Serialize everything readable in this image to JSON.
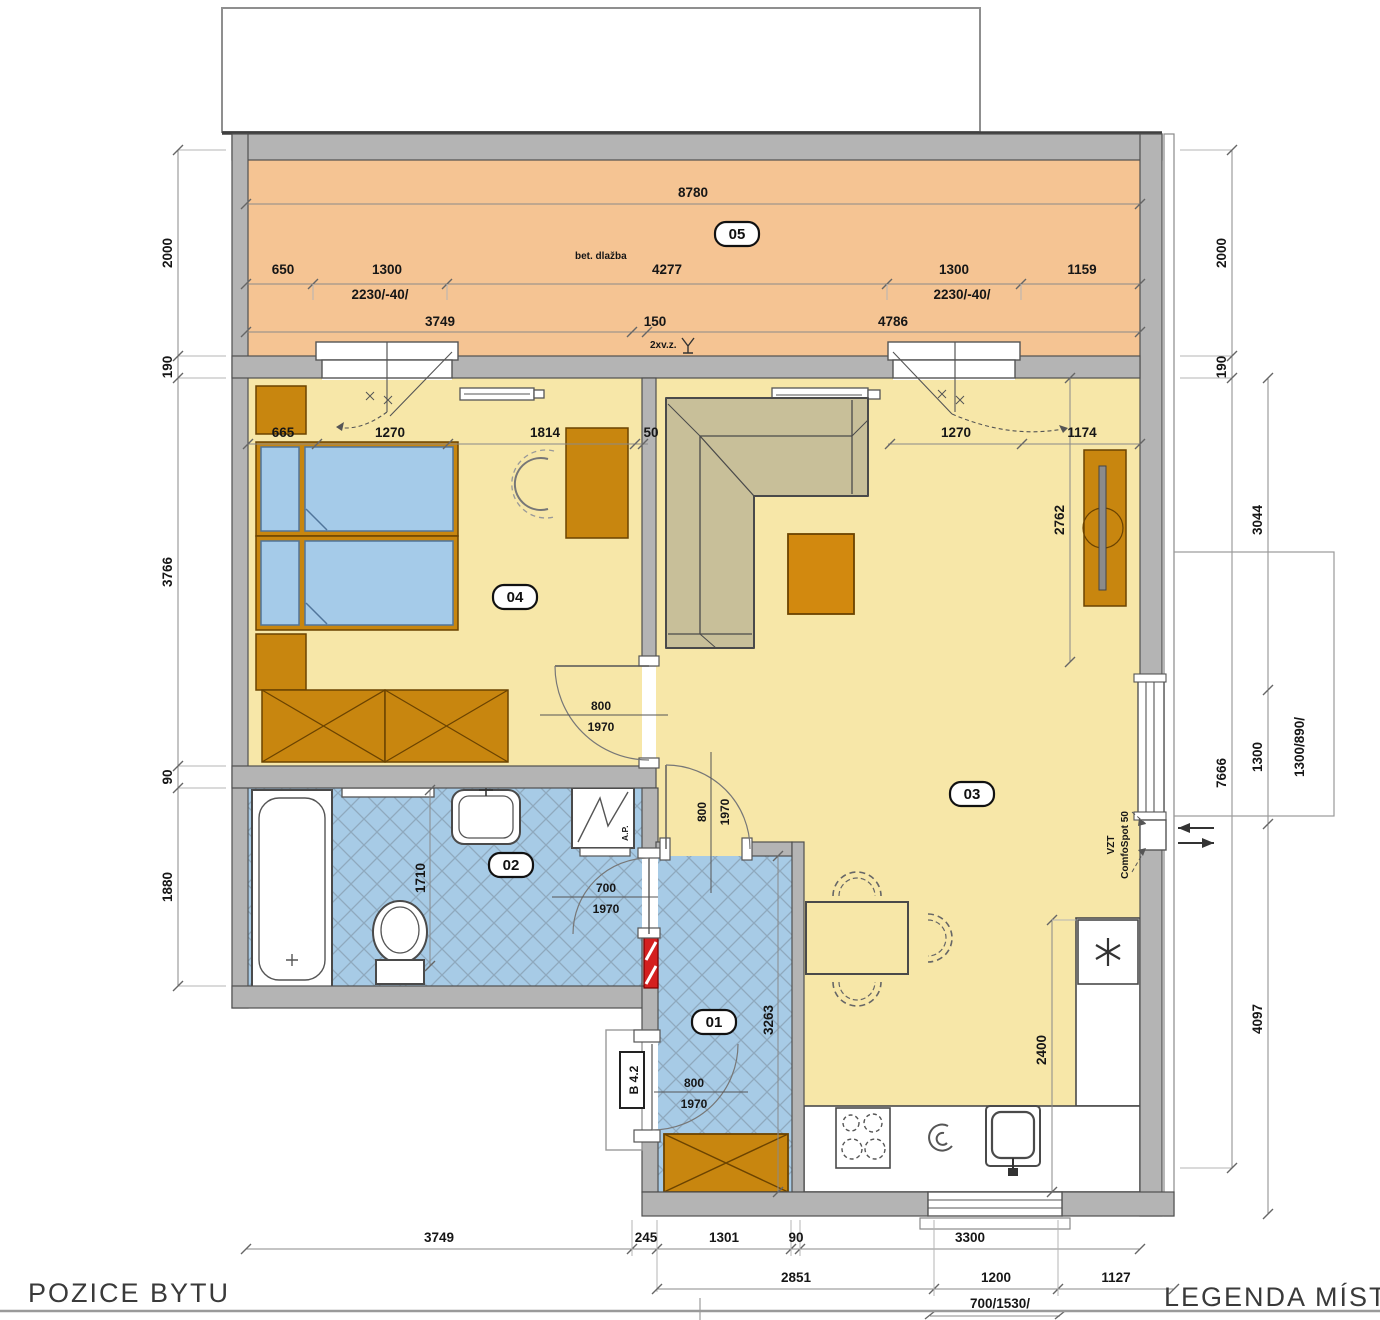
{
  "titles": {
    "position": "POZICE BYTU",
    "legend": "LEGENDA MÍSTN"
  },
  "rooms": {
    "r05": "05",
    "r04": "04",
    "r03": "03",
    "r02": "02",
    "r01": "01"
  },
  "notes": {
    "balcony_surface": "bet. dlažba",
    "drain": "2xv.z.",
    "washer": "A.P.",
    "vzt1": "VZT",
    "vzt2": "ComfoSpot 50",
    "entry_tag": "B 4.2"
  },
  "dims": {
    "balcony_total": "8780",
    "balcony_r1": [
      "650",
      "1300",
      "4277",
      "1300",
      "1159"
    ],
    "window_left": "2230/-40/",
    "window_right": "2230/-40/",
    "balcony_r2": [
      "3749",
      "150",
      "4786"
    ],
    "room_row": [
      "665",
      "1270",
      "1814",
      "50",
      "1270",
      "1174"
    ],
    "living_depth": "2762",
    "kitchen_run": "2400",
    "bath_width": "1710",
    "hall_depth": "3263",
    "left": [
      "2000",
      "190",
      "3766",
      "90",
      "1880"
    ],
    "right_outer": [
      "2000",
      "190",
      "7666"
    ],
    "right_inner": [
      "3044",
      "1300",
      "4097"
    ],
    "right_window_size": "1300/890/",
    "bottom_r1": [
      "3749",
      "245",
      "1301",
      "90",
      "3300"
    ],
    "bottom_r2": [
      "2851",
      "1200",
      "1127"
    ],
    "bottom_window_size": "700/1530/",
    "door_livbed": {
      "w": "800",
      "h": "1970"
    },
    "door_hall_liv": {
      "w": "800",
      "h": "1970"
    },
    "door_bath": {
      "w": "700",
      "h": "1970"
    },
    "door_entry": {
      "w": "800",
      "h": "1970"
    }
  }
}
